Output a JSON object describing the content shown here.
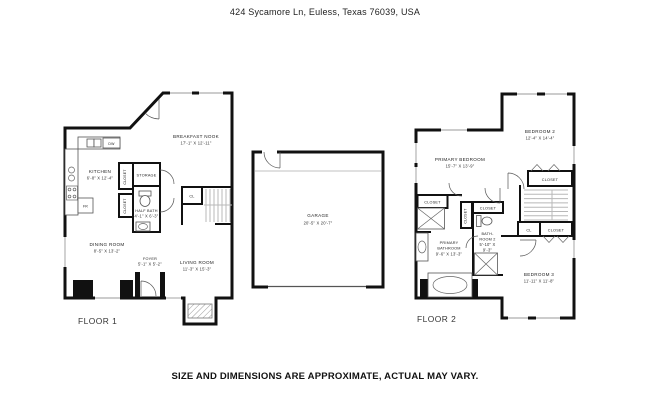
{
  "header": {
    "address": "424 Sycamore Ln, Euless, Texas 76039, USA"
  },
  "footer": {
    "disclaimer": "SIZE AND DIMENSIONS ARE APPROXIMATE, ACTUAL MAY VARY."
  },
  "floor1": {
    "label": "FLOOR 1",
    "rooms": {
      "breakfast_nook": {
        "name": "BREAKFAST NOOK",
        "dims": "17'-1\" X 12'-11\""
      },
      "kitchen": {
        "name": "KITCHEN",
        "dims": "6'-8\" X 12'-4\""
      },
      "storage": {
        "name": "STORAGE"
      },
      "half_bath": {
        "name": "HALF BATH",
        "dims": "4'-1\" X 6'-3\""
      },
      "dining_room": {
        "name": "DINING ROOM",
        "dims": "8'-5\" X 13'-2\""
      },
      "foyer": {
        "name": "FOYER",
        "dims": "5'-1\" X 5'-2\""
      },
      "living_room": {
        "name": "LIVING ROOM",
        "dims": "11'-3\" X 15'-3\""
      },
      "closet_upper": {
        "name": "CLOSET"
      },
      "closet_lower": {
        "name": "CLOSET"
      },
      "cl": {
        "name": "CL"
      },
      "dishwasher": {
        "name": "DW"
      },
      "refrigerator": {
        "name": "FR"
      }
    }
  },
  "garage": {
    "name": "GARAGE",
    "dims": "20'-5\" X 20'-7\""
  },
  "floor2": {
    "label": "FLOOR 2",
    "rooms": {
      "primary_bedroom": {
        "name": "PRIMARY BEDROOM",
        "dims": "15'-7\" X 13'-9\""
      },
      "bedroom2": {
        "name": "BEDROOM 2",
        "dims": "12'-4\" X 14'-4\""
      },
      "bedroom3": {
        "name": "BEDROOM 3",
        "dims": "11'-11\" X 11'-8\""
      },
      "primary_bathroom": {
        "name_line1": "PRIMARY",
        "name_line2": "BATHROOM",
        "dims": "9'-6\" X 13'-3\""
      },
      "bathroom2": {
        "name_line1": "BATH-",
        "name_line2": "ROOM 2",
        "dims_line1": "5'-10\" X",
        "dims_line2": "9'-3\""
      },
      "closet_left": {
        "name": "CLOSET"
      },
      "closet_mid": {
        "name": "CLOSET"
      },
      "closet_vert": {
        "name": "CLOSET"
      },
      "closet_top": {
        "name": "CLOSET"
      },
      "closet_right": {
        "name": "CLOSET"
      },
      "cl": {
        "name": "CL"
      }
    }
  }
}
